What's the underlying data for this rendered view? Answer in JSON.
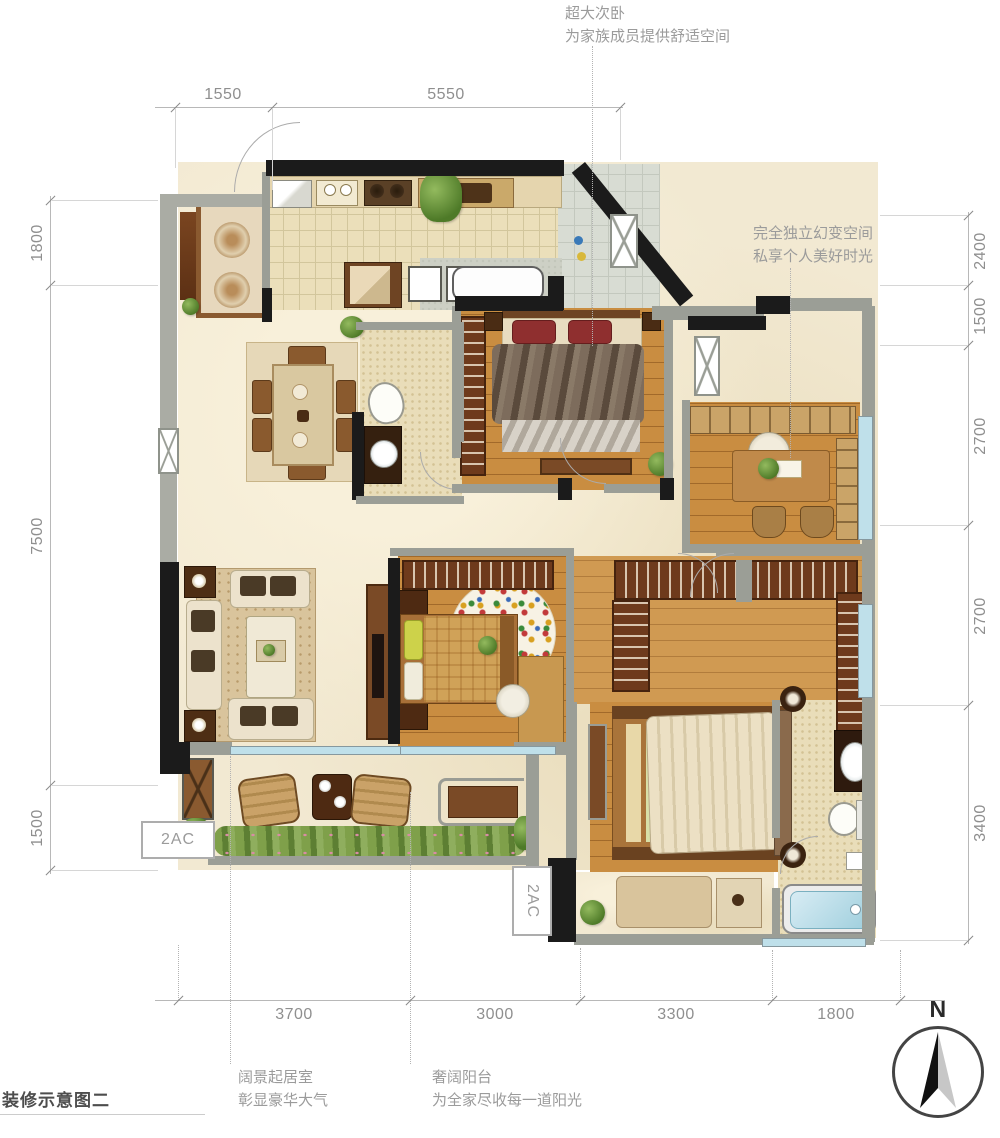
{
  "title": "装修示意图二",
  "compass": {
    "label": "N"
  },
  "annotations": {
    "top_bedroom": {
      "line1": "超大次卧",
      "line2": "为家族成员提供舒适空间"
    },
    "study": {
      "line1": "完全独立幻变空间",
      "line2": "私享个人美好时光"
    },
    "living_room": {
      "line1": "阔景起居室",
      "line2": "彰显豪华大气"
    },
    "balcony": {
      "line1": "奢阔阳台",
      "line2": "为全家尽收每一道阳光"
    }
  },
  "dimensions": {
    "top": [
      "1550",
      "5550"
    ],
    "left": [
      "1800",
      "7500",
      "1500"
    ],
    "right": [
      "2400",
      "1500",
      "2700",
      "2700",
      "3400"
    ],
    "bottom": [
      "3700",
      "3000",
      "3300",
      "1800"
    ]
  },
  "labels": {
    "ac_unit_left": "2AC",
    "ac_unit_bottom": "2AC"
  },
  "colors": {
    "wall_black": "#1b1b1b",
    "wall_gray": "#9b9e96",
    "wood": "#c98d41",
    "wood_light": "#d09a52",
    "floor_cream": "#f2e9d2",
    "tile_beige": "#ebdfba",
    "tile_gray": "#d8dcd3",
    "window_blue": "#bfe0ea",
    "hedge_green": "#7a9a48",
    "dim_text": "#8f8f8f",
    "annotation_text": "#9b9b9b"
  }
}
